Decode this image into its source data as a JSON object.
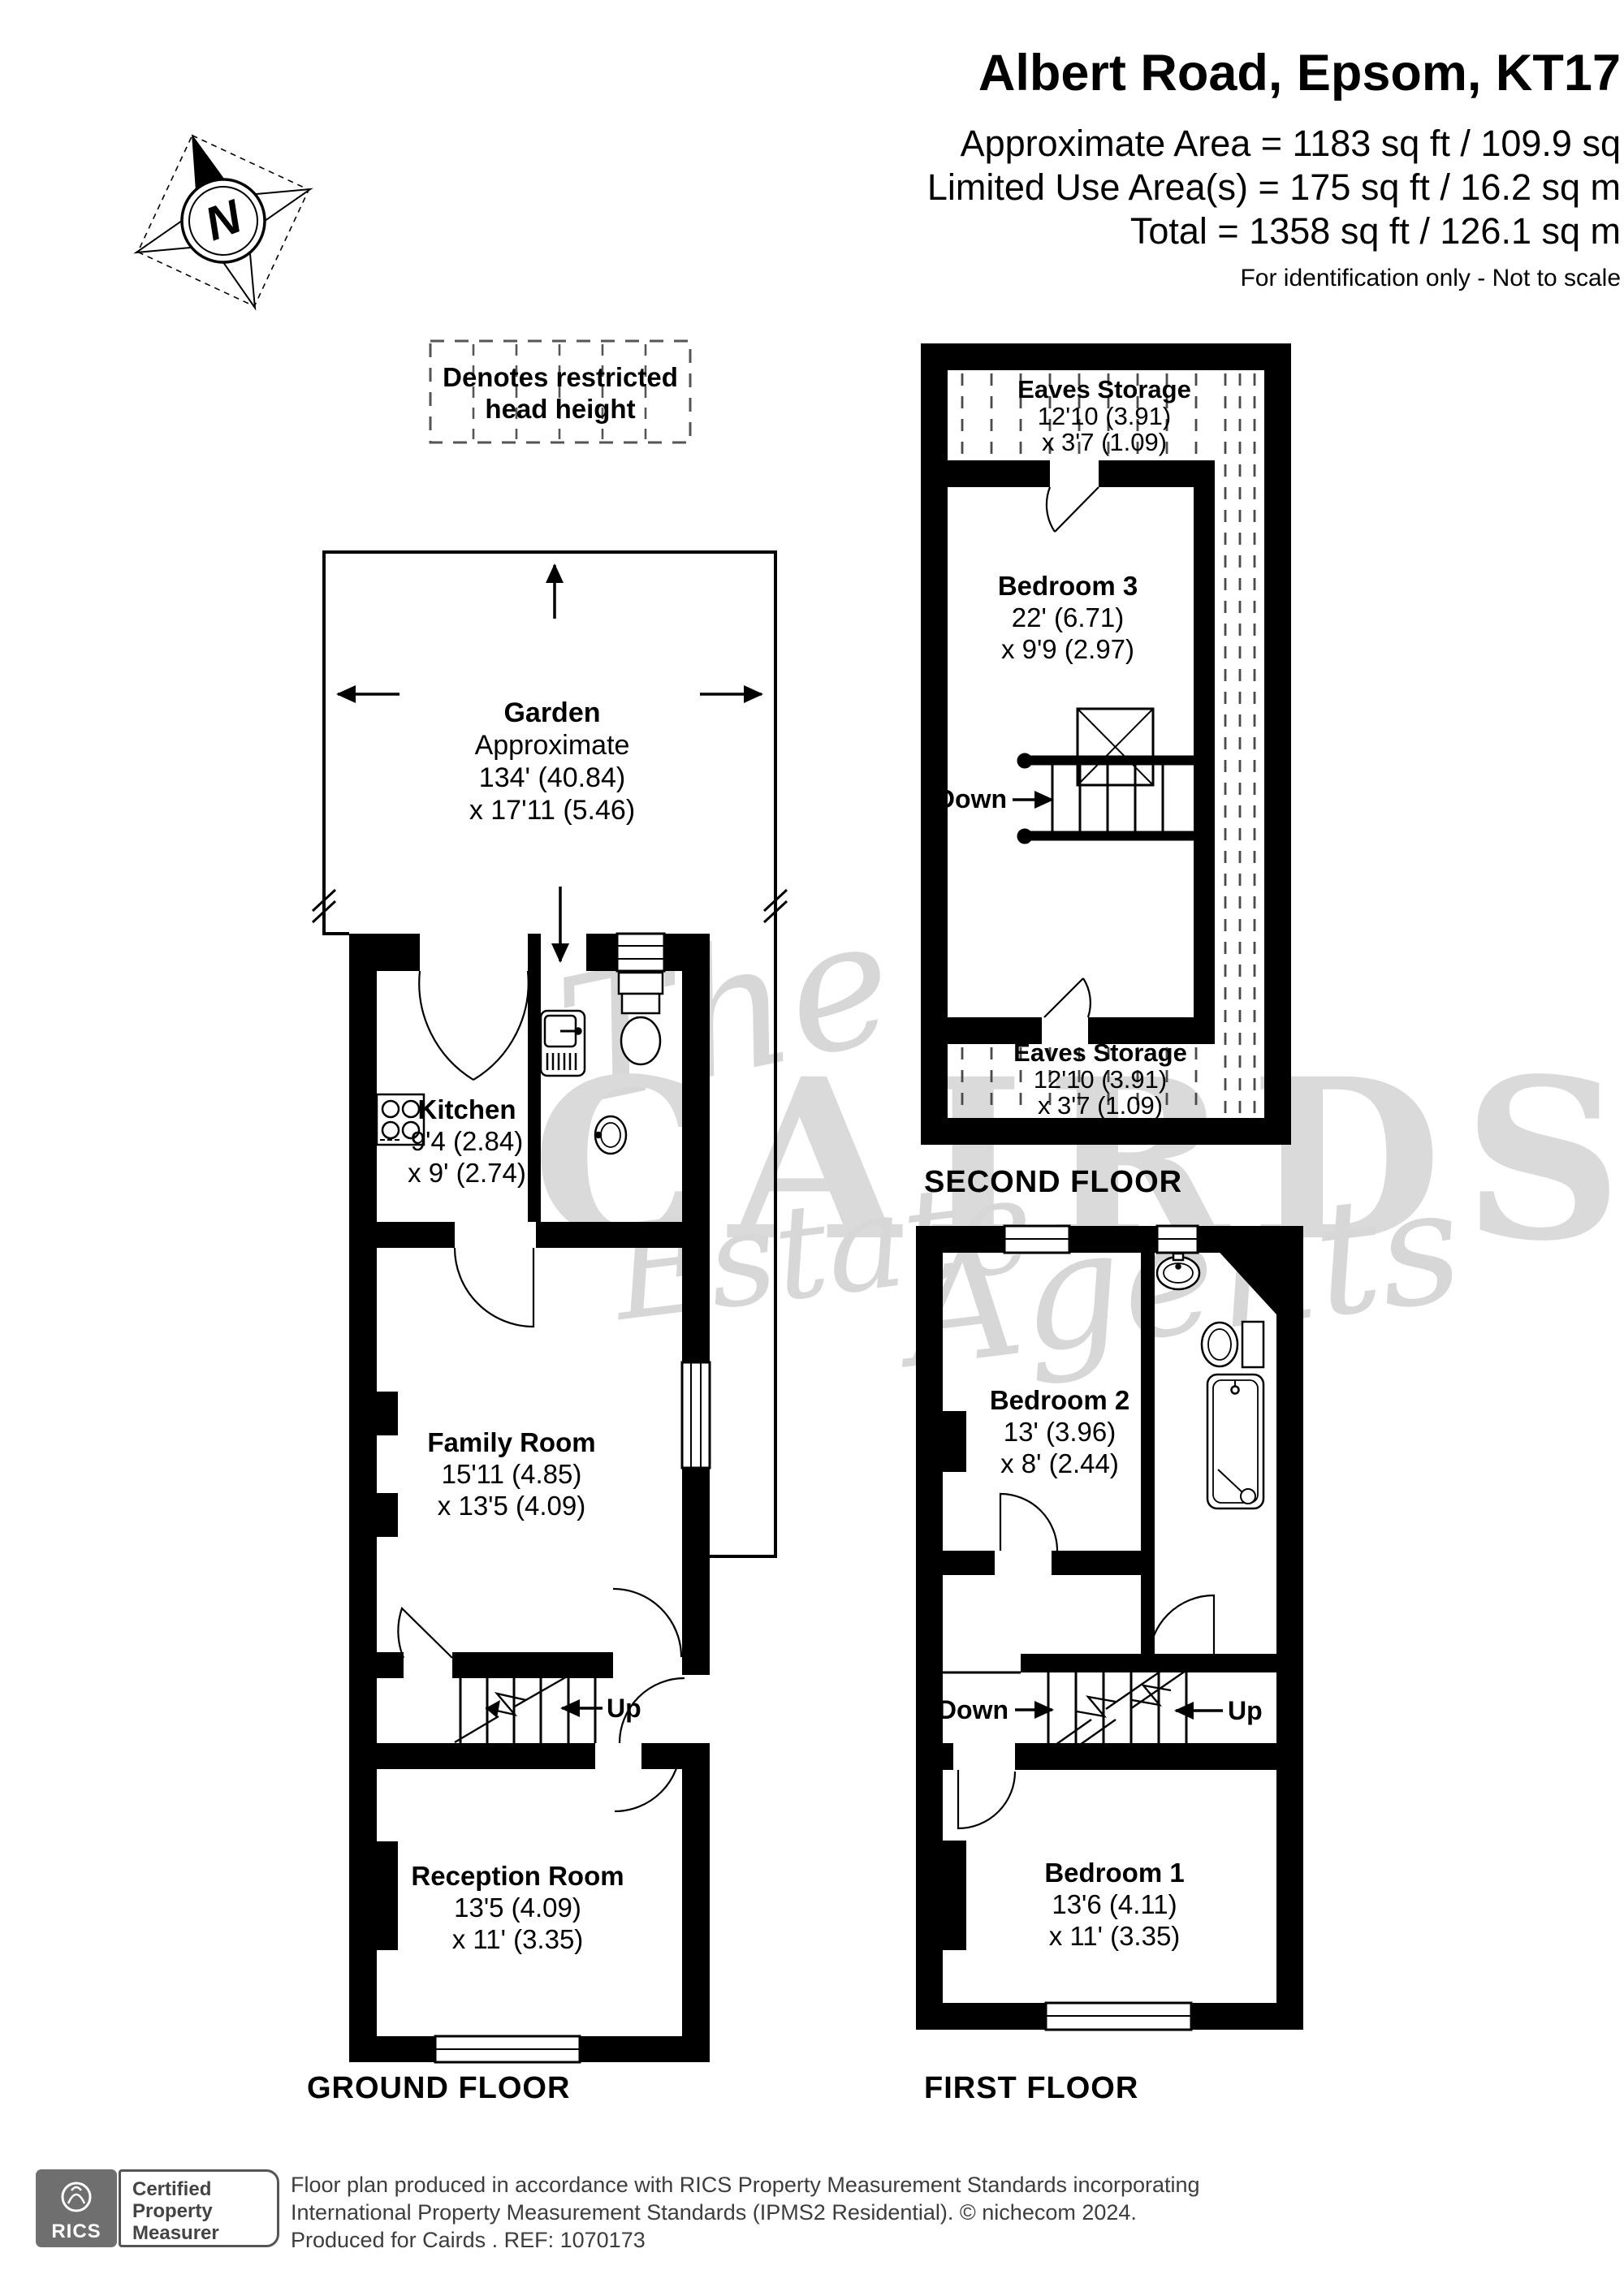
{
  "header": {
    "title": "Albert Road, Epsom, KT17",
    "area_lines": [
      "Approximate Area = 1183 sq ft / 109.9 sq",
      "Limited Use Area(s) = 175 sq ft / 16.2 sq m",
      "Total = 1358 sq ft / 126.1 sq m"
    ],
    "disclaimer": "For identification only - Not to scale"
  },
  "compass": {
    "north_label": "N"
  },
  "legend": {
    "line1": "Denotes restricted",
    "line2": "head height"
  },
  "watermark": {
    "the": "The",
    "cairds": "CAIRDS",
    "estate": "Estate",
    "agents": "Agents"
  },
  "ground_floor": {
    "label": "GROUND FLOOR",
    "garden": {
      "name": "Garden",
      "qualifier": "Approximate",
      "dim1": "134' (40.84)",
      "dim2": "x 17'11 (5.46)"
    },
    "kitchen": {
      "name": "Kitchen",
      "dim1": "9'4 (2.84)",
      "dim2": "x 9' (2.74)"
    },
    "family_room": {
      "name": "Family Room",
      "dim1": "15'11 (4.85)",
      "dim2": "x 13'5 (4.09)"
    },
    "reception_room": {
      "name": "Reception Room",
      "dim1": "13'5 (4.09)",
      "dim2": "x 11' (3.35)"
    },
    "up_label": "Up"
  },
  "second_floor": {
    "label": "SECOND FLOOR",
    "eaves_storage_top": {
      "name": "Eaves Storage",
      "dim1": "12'10 (3.91)",
      "dim2": "x 3'7 (1.09)"
    },
    "bedroom3": {
      "name": "Bedroom 3",
      "dim1": "22' (6.71)",
      "dim2": "x 9'9 (2.97)"
    },
    "eaves_storage_bottom": {
      "name": "Eaves Storage",
      "dim1": "12'10 (3.91)",
      "dim2": "x 3'7 (1.09)"
    },
    "down_label": "Down"
  },
  "first_floor": {
    "label": "FIRST FLOOR",
    "bedroom2": {
      "name": "Bedroom 2",
      "dim1": "13' (3.96)",
      "dim2": "x 8' (2.44)"
    },
    "bedroom1": {
      "name": "Bedroom 1",
      "dim1": "13'6 (4.11)",
      "dim2": "x 11' (3.35)"
    },
    "down_label": "Down",
    "up_label": "Up"
  },
  "footer": {
    "rics_label": "RICS",
    "certified": [
      "Certified",
      "Property",
      "Measurer"
    ],
    "line1": "Floor plan produced in accordance with RICS Property Measurement Standards incorporating",
    "line2": "International Property Measurement Standards (IPMS2 Residential).  © nichecom 2024.",
    "line3": "Produced for Cairds .  REF: 1070173"
  },
  "colors": {
    "wall": "#000000",
    "hatch": "#4a4a4a",
    "watermark": "#d7d7d7",
    "footer_text": "#3d3d3d",
    "rics_box": "#6f6f6f"
  }
}
